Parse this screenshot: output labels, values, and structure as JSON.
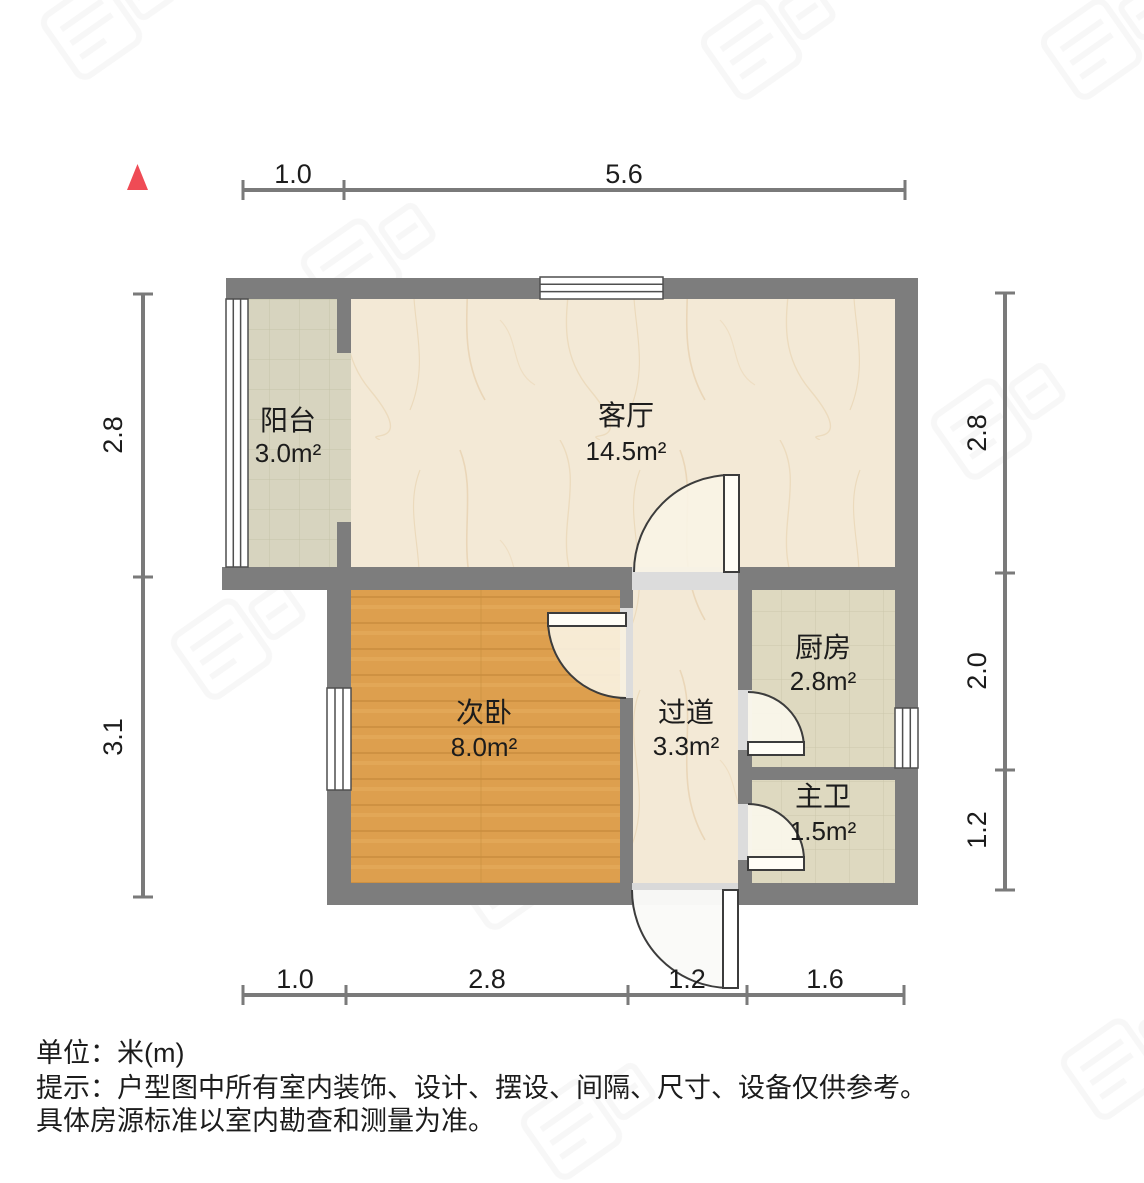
{
  "title": "户型图",
  "unit_note": "单位：米(m)",
  "tip_line1": "提示：户型图中所有室内装饰、设计、摆设、间隔、尺寸、设备仅供参考。",
  "tip_line2": "具体房源标准以室内勘查和测量为准。",
  "rooms": {
    "balcony": {
      "name": "阳台",
      "area": "3.0m²"
    },
    "living": {
      "name": "客厅",
      "area": "14.5m²"
    },
    "bedroom": {
      "name": "次卧",
      "area": "8.0m²"
    },
    "hallway": {
      "name": "过道",
      "area": "3.3m²"
    },
    "kitchen": {
      "name": "厨房",
      "area": "2.8m²"
    },
    "bathroom": {
      "name": "主卫",
      "area": "1.5m²"
    }
  },
  "dimensions": {
    "top": [
      "1.0",
      "5.6"
    ],
    "bottom": [
      "1.0",
      "2.8",
      "1.2",
      "1.6"
    ],
    "left": [
      "2.8",
      "3.1"
    ],
    "right": [
      "2.8",
      "2.0",
      "1.2"
    ]
  },
  "colors": {
    "wall": "#7d7d7d",
    "north_arrow": "#ef4b55",
    "wood_floor": "#dd9f4e",
    "marble_floor": "#f3e9d6",
    "balcony_tile": "#d7d4bf",
    "kitchen_tile": "#ded9c0",
    "dimension_line": "#7a7a7a"
  }
}
